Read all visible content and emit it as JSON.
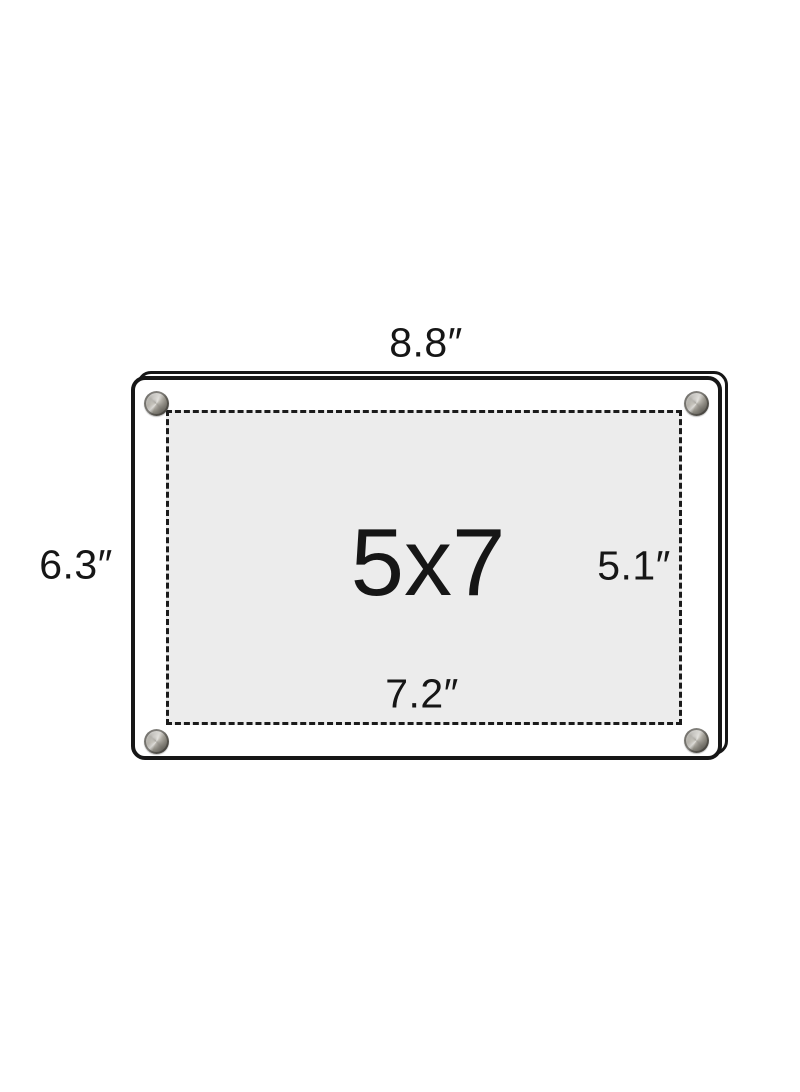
{
  "diagram": {
    "product_size_label": "5x7",
    "dimensions": {
      "outer_width_label": "8.8″",
      "outer_height_label": "6.3″",
      "inner_width_label": "7.2″",
      "inner_height_label": "5.1″"
    },
    "colors": {
      "background": "#ffffff",
      "frame_outline": "#161616",
      "photo_area_fill": "#ececec",
      "screw_metal": "#8d8a81"
    },
    "icons": {
      "corner_fasteners": "standoff-screw-icon"
    }
  }
}
